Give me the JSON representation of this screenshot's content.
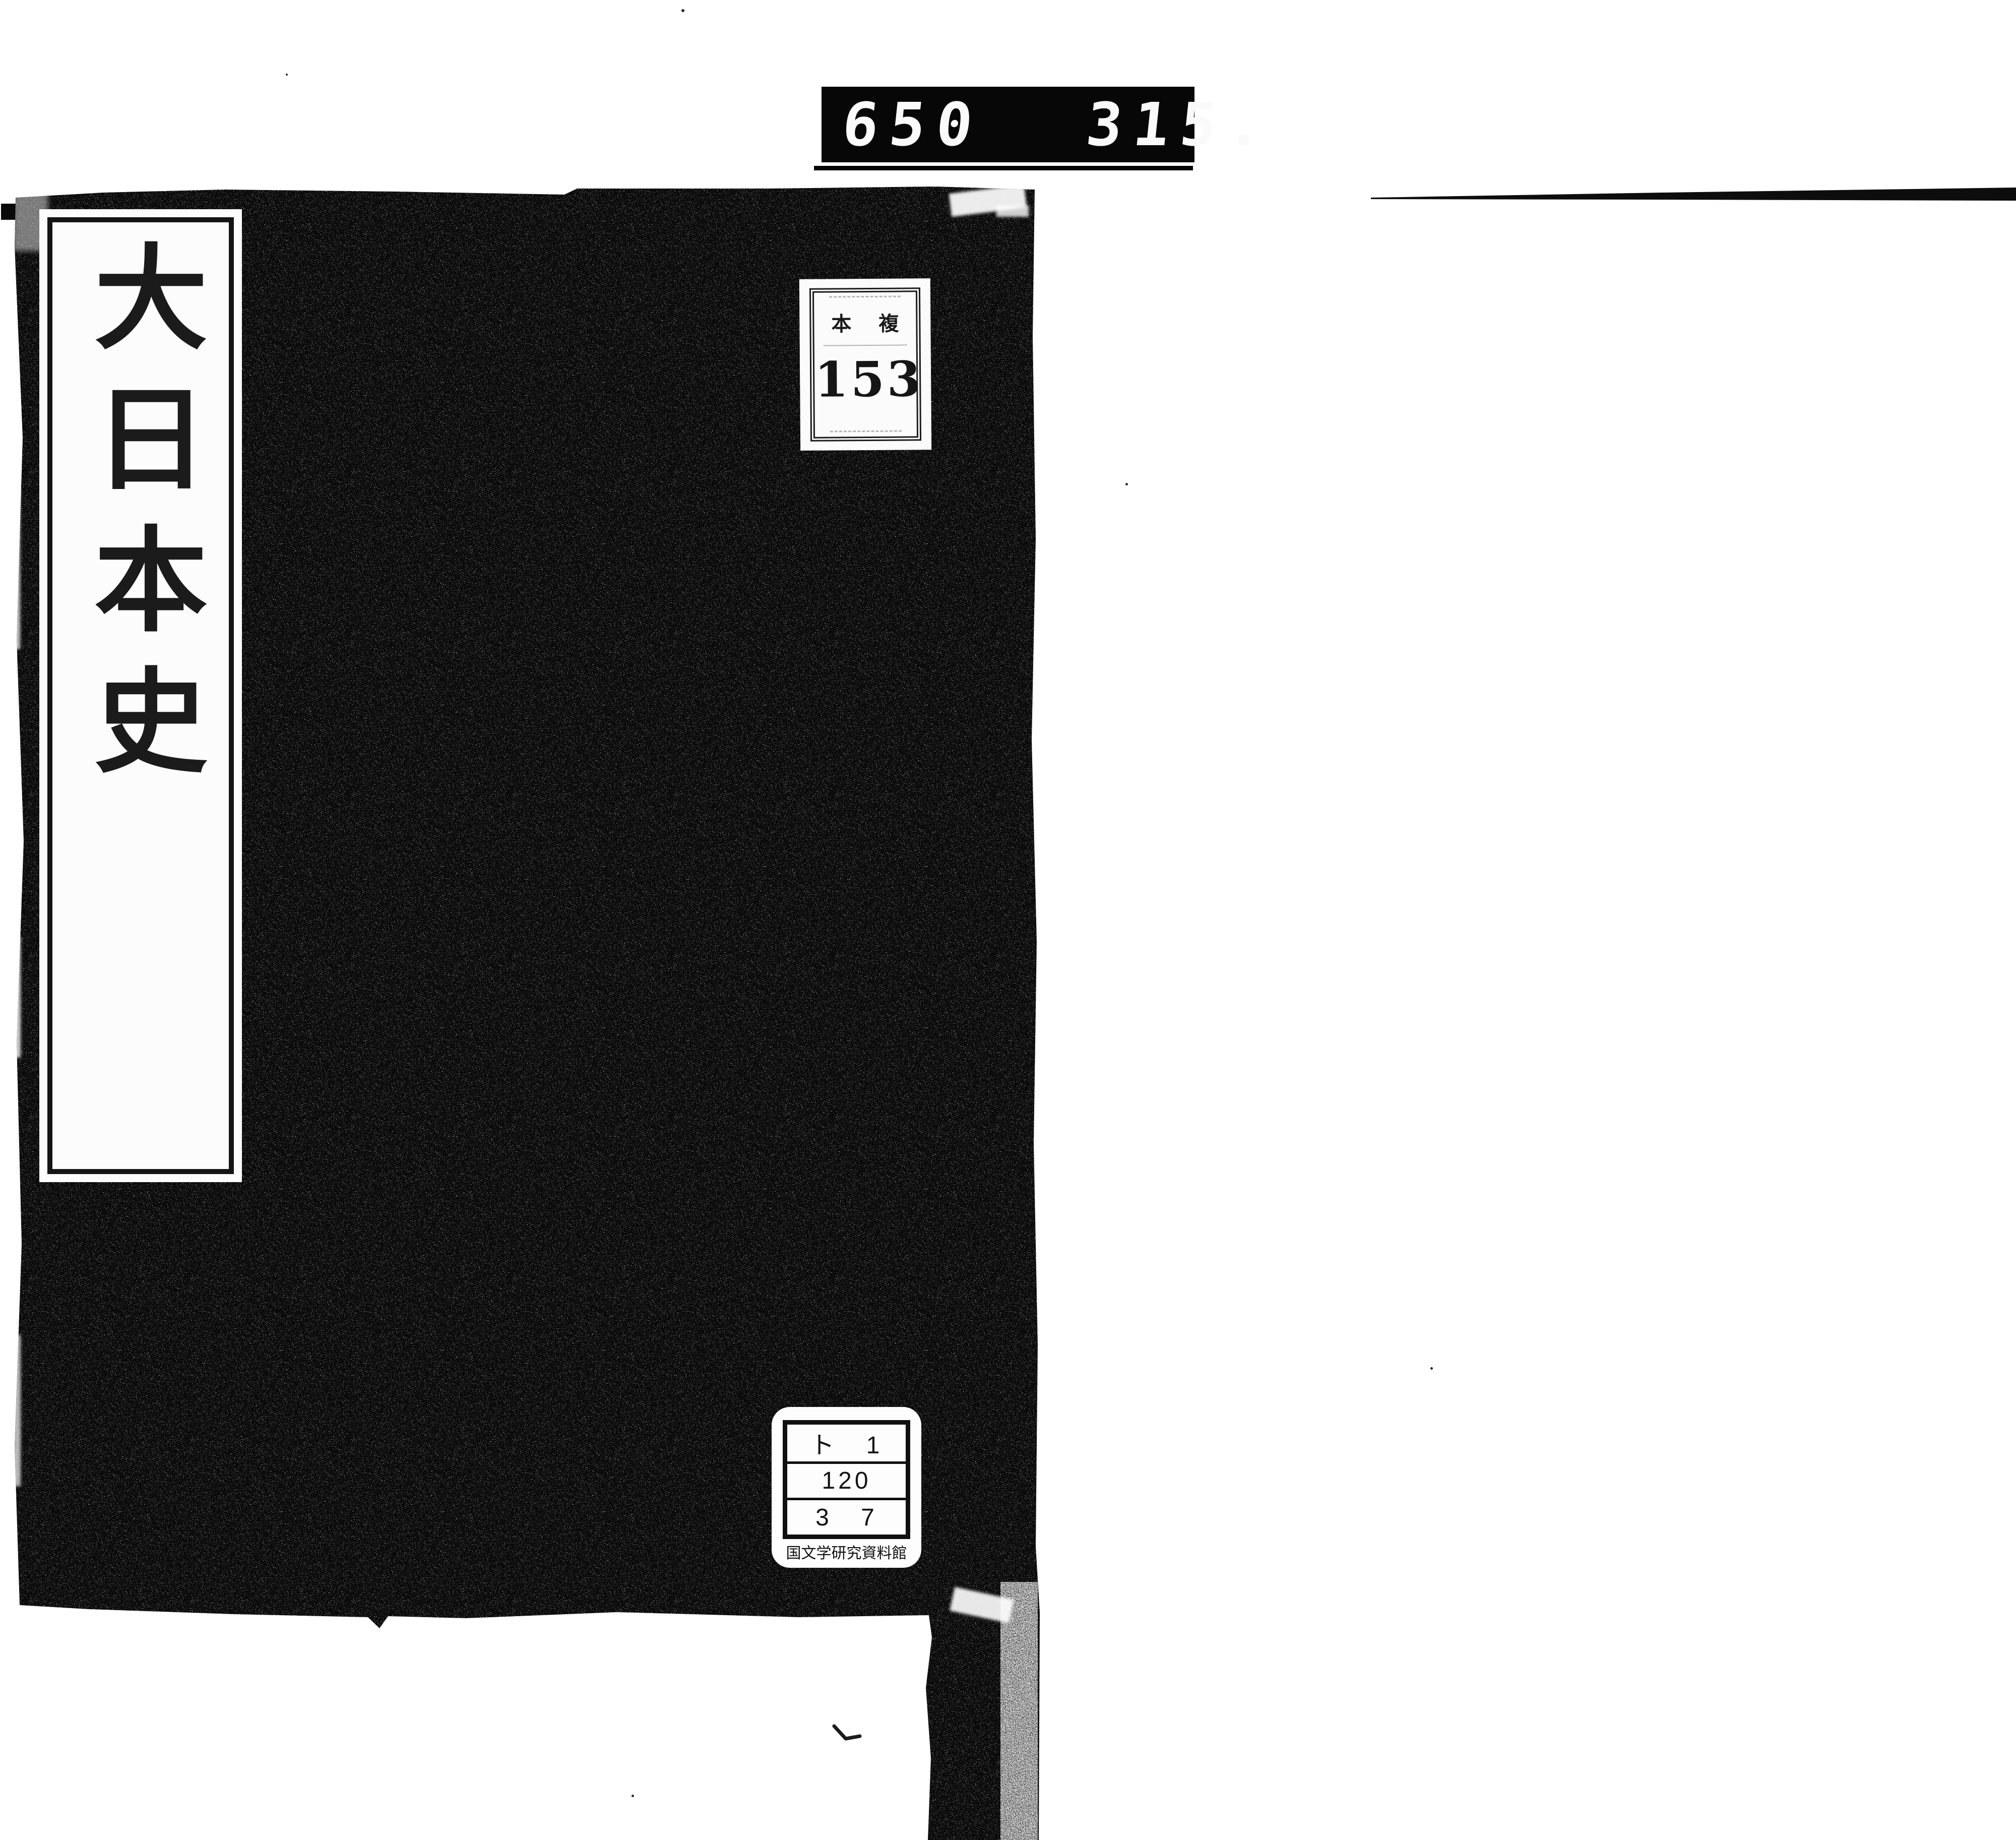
{
  "page": {
    "paper_color": "#ffffff",
    "cover_color": "#0b0b0b"
  },
  "counter": {
    "left": "650",
    "right": "315."
  },
  "title_slip": {
    "title": "大日本史"
  },
  "copy_label": {
    "left_char": "本",
    "right_char": "複",
    "number": "153"
  },
  "library_label": {
    "row1": "ト 1",
    "row2": "120",
    "row3": "3 7",
    "institution": "国文学研究資料館"
  }
}
